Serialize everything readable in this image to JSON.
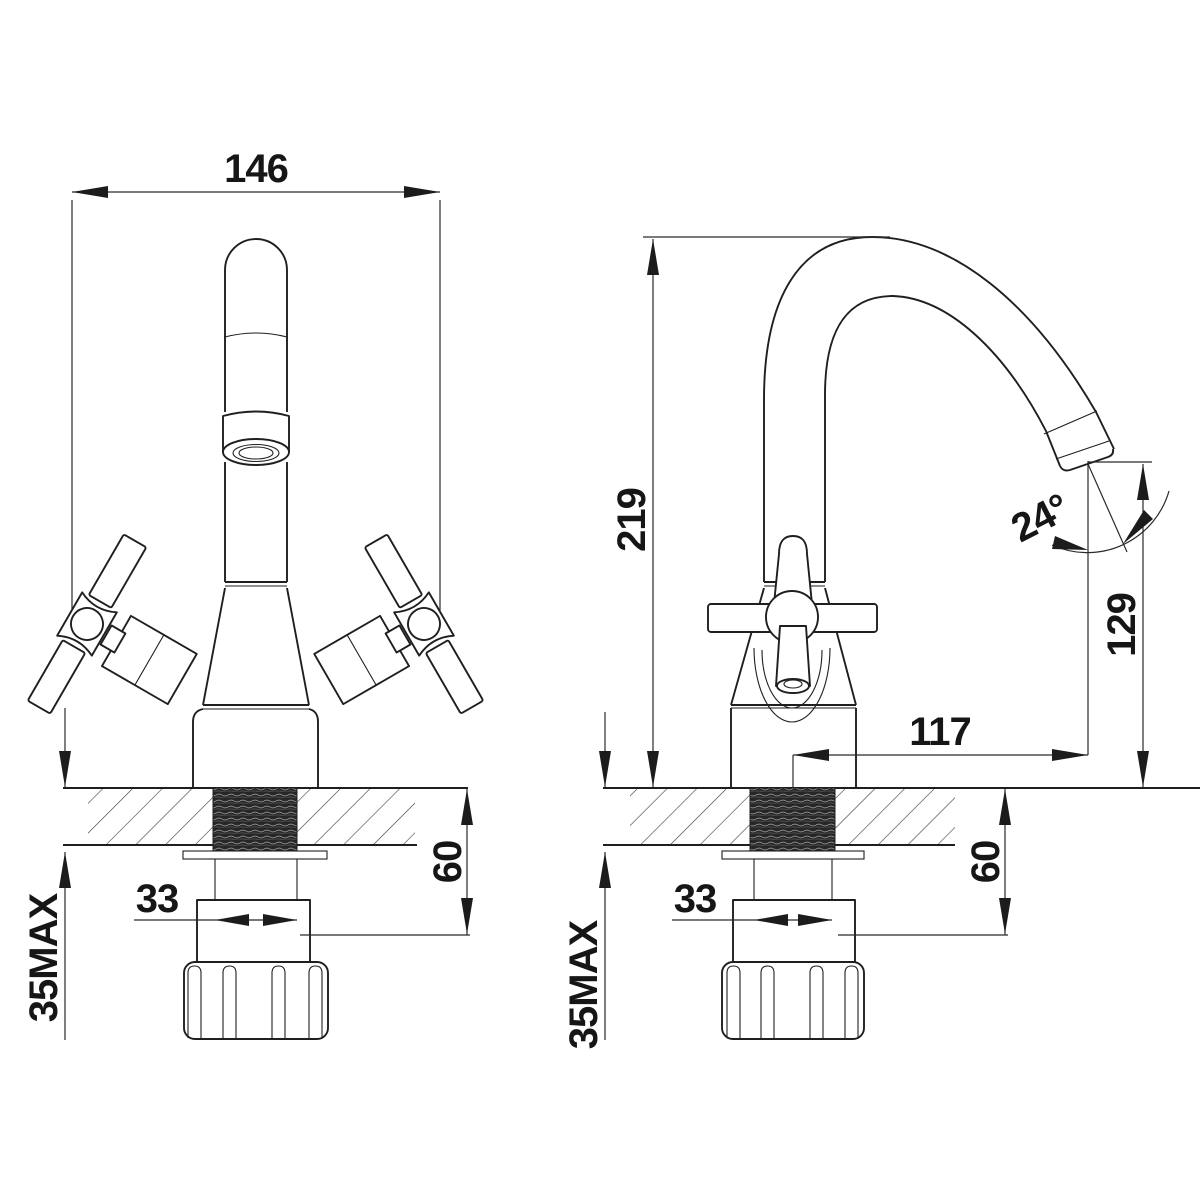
{
  "drawing": {
    "type": "faucet-installation-dimension-drawing",
    "background_color": "#ffffff",
    "line_color": "#1f1f1f",
    "hatch_color": "#3a3a3a",
    "thread_fill_color": "#262626"
  },
  "dimensions": {
    "front_view": {
      "overall_width": "146",
      "shank_length": "60",
      "shank_diameter": "33",
      "max_deck_thickness": "35MAX"
    },
    "side_view": {
      "overall_height": "219",
      "outlet_height": "129",
      "spout_reach": "117",
      "outlet_angle": "24°",
      "shank_length": "60",
      "shank_diameter": "33",
      "max_deck_thickness": "35MAX"
    }
  }
}
